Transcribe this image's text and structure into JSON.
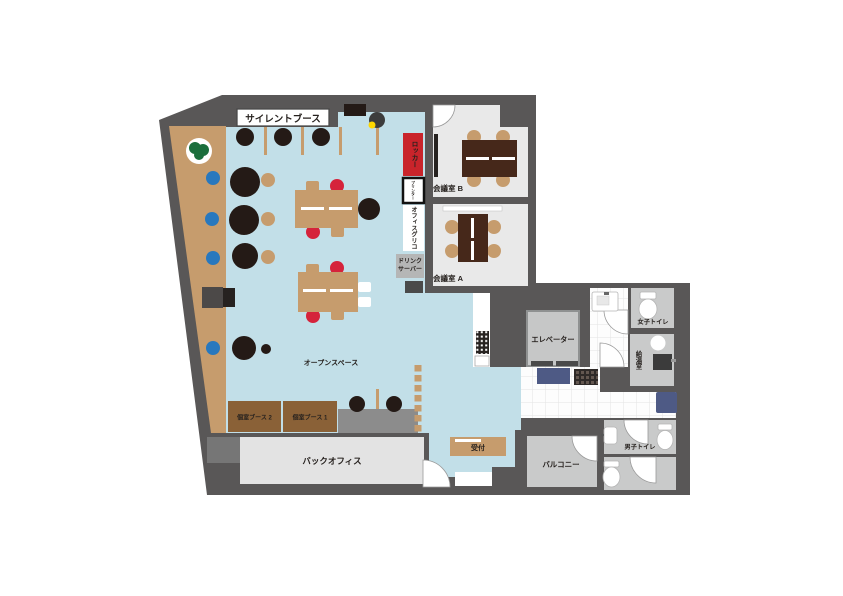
{
  "plan": {
    "labels": {
      "silent_booth": "サイレントブース",
      "meeting_room_b": "会議室 B",
      "meeting_room_a": "会議室 A",
      "locker": "ロッカー",
      "printer": "プリンター",
      "office_glico": "オフィスグリコ",
      "drink_server_line1": "ドリンク",
      "drink_server_line2": "サーバー",
      "open_space": "オープンスペース",
      "private_booth_2": "個室ブース 2",
      "private_booth_1": "個室ブース 1",
      "back_office": "バックオフィス",
      "reception": "受付",
      "elevator": "エレベーター",
      "womens_toilet": "女子トイレ",
      "kitchenette": "給湯室",
      "mens_toilet": "男子トイレ",
      "balcony": "バルコニー"
    },
    "colors": {
      "wall": "#595757",
      "open_space_floor": "#c2dfe8",
      "wood": "#c69c6d",
      "room_floor_light": "#e9e9e9",
      "room_floor_gray": "#c9caca",
      "table_dark_brown": "#46281a",
      "booth_brown": "#8a6137",
      "locker_red": "#c9242b",
      "chair_red": "#d5233b",
      "chair_blue": "#2878be",
      "mat_navy": "#4e5a85",
      "chair_black": "#241a16",
      "plant_green": "#1b6e3c",
      "accent_yellow": "#ffd800"
    }
  }
}
